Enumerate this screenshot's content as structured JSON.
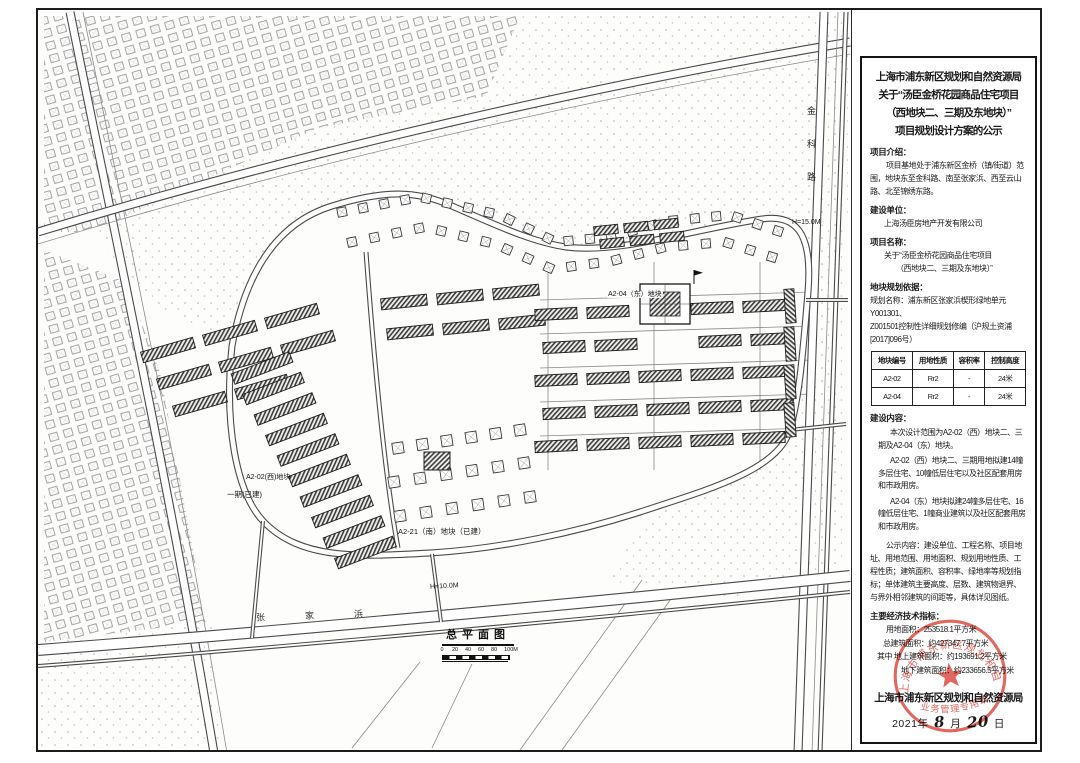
{
  "map": {
    "labels": {
      "parcel_west": "A2-02(西)地块",
      "phase_one": "一期(已建)",
      "parcel_south": "A2-21（南）地块（已建）",
      "parcel_east": "A2-04（东）地块",
      "height_east": "H=15.0M",
      "height_south": "H=10.0M",
      "river": "张家浜",
      "road_east": "金科路"
    },
    "plan_title": "总平面图",
    "scale_ticks": [
      "0",
      "20",
      "40",
      "60",
      "80",
      "100M"
    ]
  },
  "panel": {
    "title_lines": [
      "上海市浦东新区规划和自然资源局",
      "关于“汤臣金桥花园商品住宅项目",
      "（西地块二、三期及东地块）”",
      "项目规划设计方案的公示"
    ],
    "intro_label": "项目介绍：",
    "intro_text": "项目基地处于浦东新区金桥（镇/街道）范围，地块东至金科路、南至张家浜、西至云山路、北至锦绣东路。",
    "builder_label": "建设单位：",
    "builder_name": "上海汤臣房地产开发有限公司",
    "project_label": "项目名称：",
    "project_name_lines": [
      "关于“汤臣金桥花园商品住宅项目",
      "（西地块二、三期及东地块）”"
    ],
    "basis_label": "地块规划依据：",
    "basis_lines": [
      "规划名称：浦东新区张家浜楔形绿地单元Y001301、",
      "Z001501控制性详细规划修编（沪规土资浦[2017]096号）"
    ],
    "table": {
      "headers": [
        "地块编号",
        "用地性质",
        "容积率",
        "控制高度"
      ],
      "rows": [
        [
          "A2-02",
          "Rr2",
          "-",
          "24米"
        ],
        [
          "A2-04",
          "Rr2",
          "-",
          "24米"
        ]
      ]
    },
    "content_label": "建设内容：",
    "content_paras": [
      "本次设计范围为A2-02（西）地块二、三期及A2-04（东）地块。",
      "A2-02（西）地块二、三期用地拟建14幢多层住宅、10幢低层住宅以及社区配套用房和市政用房。",
      "A2-04（东）地块拟建24幢多层住宅、16幢低层住宅、1幢商业建筑以及社区配套用房和市政用房。"
    ],
    "notice_text": "公示内容：建设单位、工程名称、项目地址、用地范围、用地面积、规划用地性质、工程性质；建筑面积、容积率、绿地率等规划指标；单体建筑主要高度、层数、建筑物退界、与界外相邻建筑的间距等，具体详见图纸。",
    "metrics_label": "主要经济技术指标：",
    "metrics": [
      "用地面积：253518.1平方米",
      "总建筑面积：约427347.7平方米",
      "其中 地上建筑面积：约193691.2平方米",
      "地下建筑面积：约233656.5平方米"
    ],
    "signature": "上海市浦东新区规划和自然资源局",
    "date_year": "2021年",
    "date_month": "8",
    "date_month_label": "月",
    "date_day": "20",
    "date_day_label": "日",
    "seal": {
      "ring_text": "上海市浦东新区规划和自然资源局",
      "bottom_text": "业务管理专用章",
      "color": "#d9473b"
    }
  }
}
